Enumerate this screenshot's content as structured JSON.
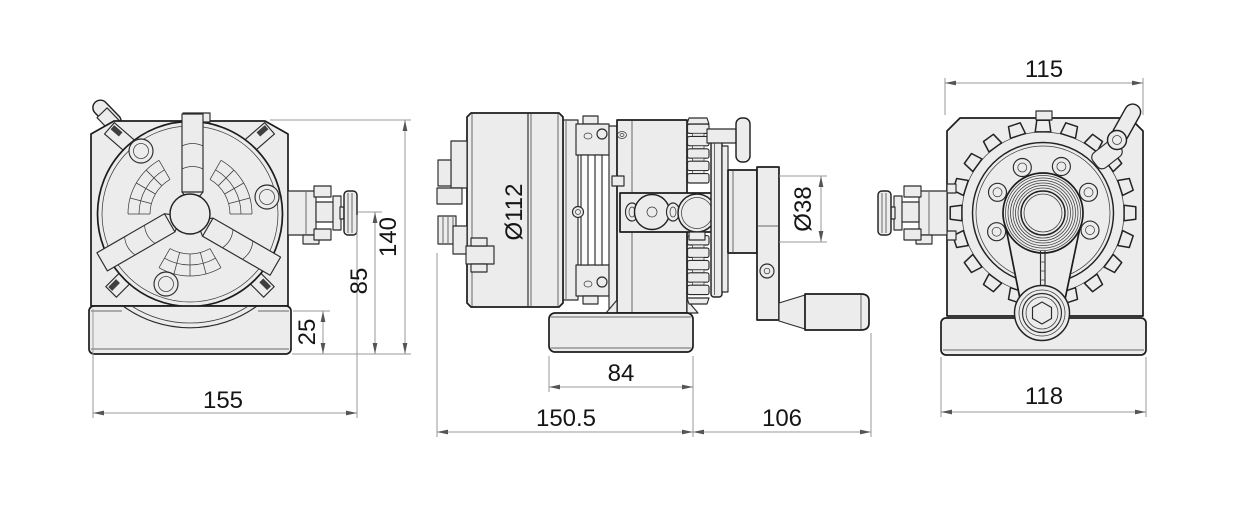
{
  "drawing": {
    "type": "technical-drawing-three-views",
    "subject": "rotary-indexing-table-with-3-jaw-chuck-and-hand-crank",
    "views": {
      "front": {
        "name": "front-view"
      },
      "side": {
        "name": "side-view"
      },
      "rear": {
        "name": "rear-view"
      }
    },
    "dims": {
      "front": {
        "overall_width": "155",
        "overall_height": "140",
        "center_height": "85",
        "base_height": "25"
      },
      "side": {
        "chuck_diameter": "Ø112",
        "base_length": "84",
        "body_length": "150.5",
        "crank_length": "106",
        "hub_diameter": "Ø38"
      },
      "rear": {
        "body_width": "115",
        "base_width": "118"
      }
    },
    "colors": {
      "background": "#ffffff",
      "part_fill": "#ececec",
      "outline": "#1c1c1c",
      "dimension_line": "#999999",
      "dimension_text": "#151515"
    }
  }
}
